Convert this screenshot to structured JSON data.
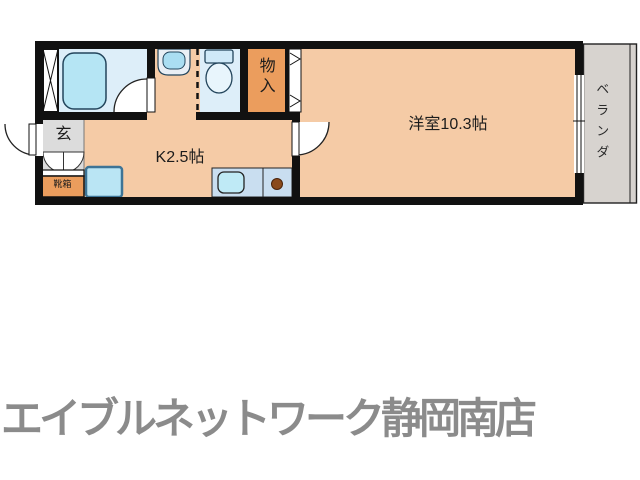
{
  "floorplan": {
    "labels": {
      "western_room": "洋室10.3帖",
      "kitchen": "K2.5帖",
      "storage": "物入",
      "entrance": "玄",
      "shoe_box": "靴箱",
      "veranda": "ベランダ"
    }
  },
  "footer": {
    "store_name": "エイブルネットワーク静岡南店"
  },
  "colors": {
    "wall": "#111111",
    "room-floor": "#f5cba6",
    "wet-floor": "#ddeef9",
    "fixture-blue": "#b5e5f4",
    "accent-orange": "#eb9d5d",
    "entrance-gray": "#dcdcdc",
    "veranda-gray": "#d7d3cf",
    "counter-blue": "#c9def0",
    "burner-brown": "#8a4a1c",
    "footer-gray": "#8b8b8b"
  }
}
